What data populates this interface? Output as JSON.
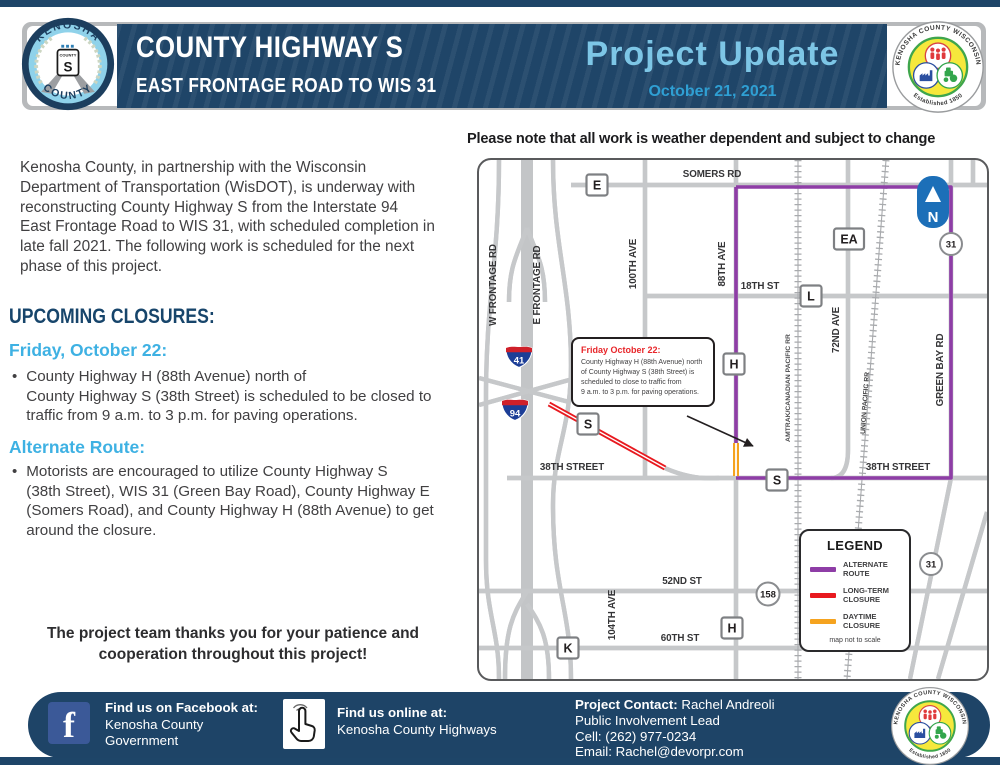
{
  "header": {
    "title": "COUNTY HIGHWAY S",
    "subtitle": "EAST FRONTAGE ROAD TO WIS 31",
    "update_label": "Project Update",
    "date": "October 21, 2021",
    "left_logo": {
      "arc_top": "KENOSHA",
      "arc_bottom": "COUNTY",
      "shield_top": "COUNTY",
      "shield_letter": "S"
    },
    "right_logo": {
      "arc_top": "KENOSHA COUNTY WISCONSIN",
      "arc_bottom": "Established 1850"
    }
  },
  "note": "Please note that all work is weather dependent and subject to change",
  "intro": "Kenosha County, in partnership with the Wisconsin\nDepartment of Transportation (WisDOT), is underway with\nreconstructing County Highway S from the Interstate 94\nEast Frontage Road to WIS 31, with scheduled completion in\nlate fall 2021. The following work is scheduled for the next\nphase of this project.",
  "closures": {
    "heading": "UPCOMING CLOSURES:",
    "date_heading": "Friday, October 22:",
    "bullet_glyph": "•",
    "bullet": "County Highway H (88th Avenue) north of\nCounty Highway S (38th Street) is scheduled to be closed to\ntraffic from 9 a.m. to 3 p.m. for paving operations."
  },
  "alternate": {
    "heading": "Alternate Route:",
    "bullet": "Motorists are encouraged to utilize County Highway S\n(38th Street), WIS 31 (Green Bay Road), County Highway E\n(Somers Road), and County Highway H (88th Avenue) to get\naround the closure."
  },
  "thanks": "The project team thanks you for your patience and\ncooperation throughout this project!",
  "map": {
    "roads": {
      "somers": "SOMERS RD",
      "w_frontage": "W FRONTAGE RD",
      "e_frontage": "E FRONTAGE RD",
      "ave100": "100TH AVE",
      "ave88": "88TH AVE",
      "st18": "18TH ST",
      "ave72": "72ND AVE",
      "amtrak": "AMTRAK/CANADIAN PACIFIC RR",
      "union": "UNION PACIFIC RR",
      "greenbay": "GREEN BAY RD",
      "st38_left": "38TH STREET",
      "st38_right": "38TH STREET",
      "st52": "52ND ST",
      "st60": "60TH ST",
      "ave104": "104TH AVE"
    },
    "shields": {
      "e": "E",
      "l": "L",
      "ea": "EA",
      "h_top": "H",
      "s_red": "S",
      "s_38": "S",
      "h_bottom": "H",
      "k": "K",
      "i41": "41",
      "i94": "94",
      "wis31_top": "31",
      "wis31_bottom": "31",
      "wis158": "158",
      "north": "N"
    },
    "callout": {
      "heading": "Friday October 22:",
      "body": "County Highway H (88th Avenue) north\nof County Highway S (38th Street) is\nscheduled to close to traffic from\n9 a.m. to 3 p.m. for paving operations."
    },
    "legend": {
      "title": "LEGEND",
      "items": [
        {
          "label": "ALTERNATE\nROUTE",
          "color": "#8e3da6"
        },
        {
          "label": "LONG-TERM\nCLOSURE",
          "color": "#e8191f"
        },
        {
          "label": "DAYTIME\nCLOSURE",
          "color": "#f5a31f"
        }
      ],
      "note": "map not to scale"
    }
  },
  "footer": {
    "facebook_icon_glyph": "f",
    "facebook_heading": "Find us on Facebook at:",
    "facebook_line1": "Kenosha County",
    "facebook_line2": "Government",
    "online_heading": "Find us online at:",
    "online_line": "Kenosha County Highways",
    "contact_label": "Project Contact:",
    "contact_name": " Rachel Andreoli",
    "contact_role": "Public Involvement Lead",
    "contact_cell": "Cell: (262) 977-0234",
    "contact_email": "Email: Rachel@devorpr.com"
  },
  "colors": {
    "navy": "#1e4568",
    "heading_light_blue": "#3eb1e3",
    "project_update_blue": "#7dc6e6",
    "alternate_route": "#8e3da6",
    "long_term_closure": "#e8191f",
    "daytime_closure": "#f5a31f",
    "north_arrow_blue": "#1c6fb8",
    "interstate_blue": "#1c3e97",
    "interstate_red": "#cf202a"
  }
}
